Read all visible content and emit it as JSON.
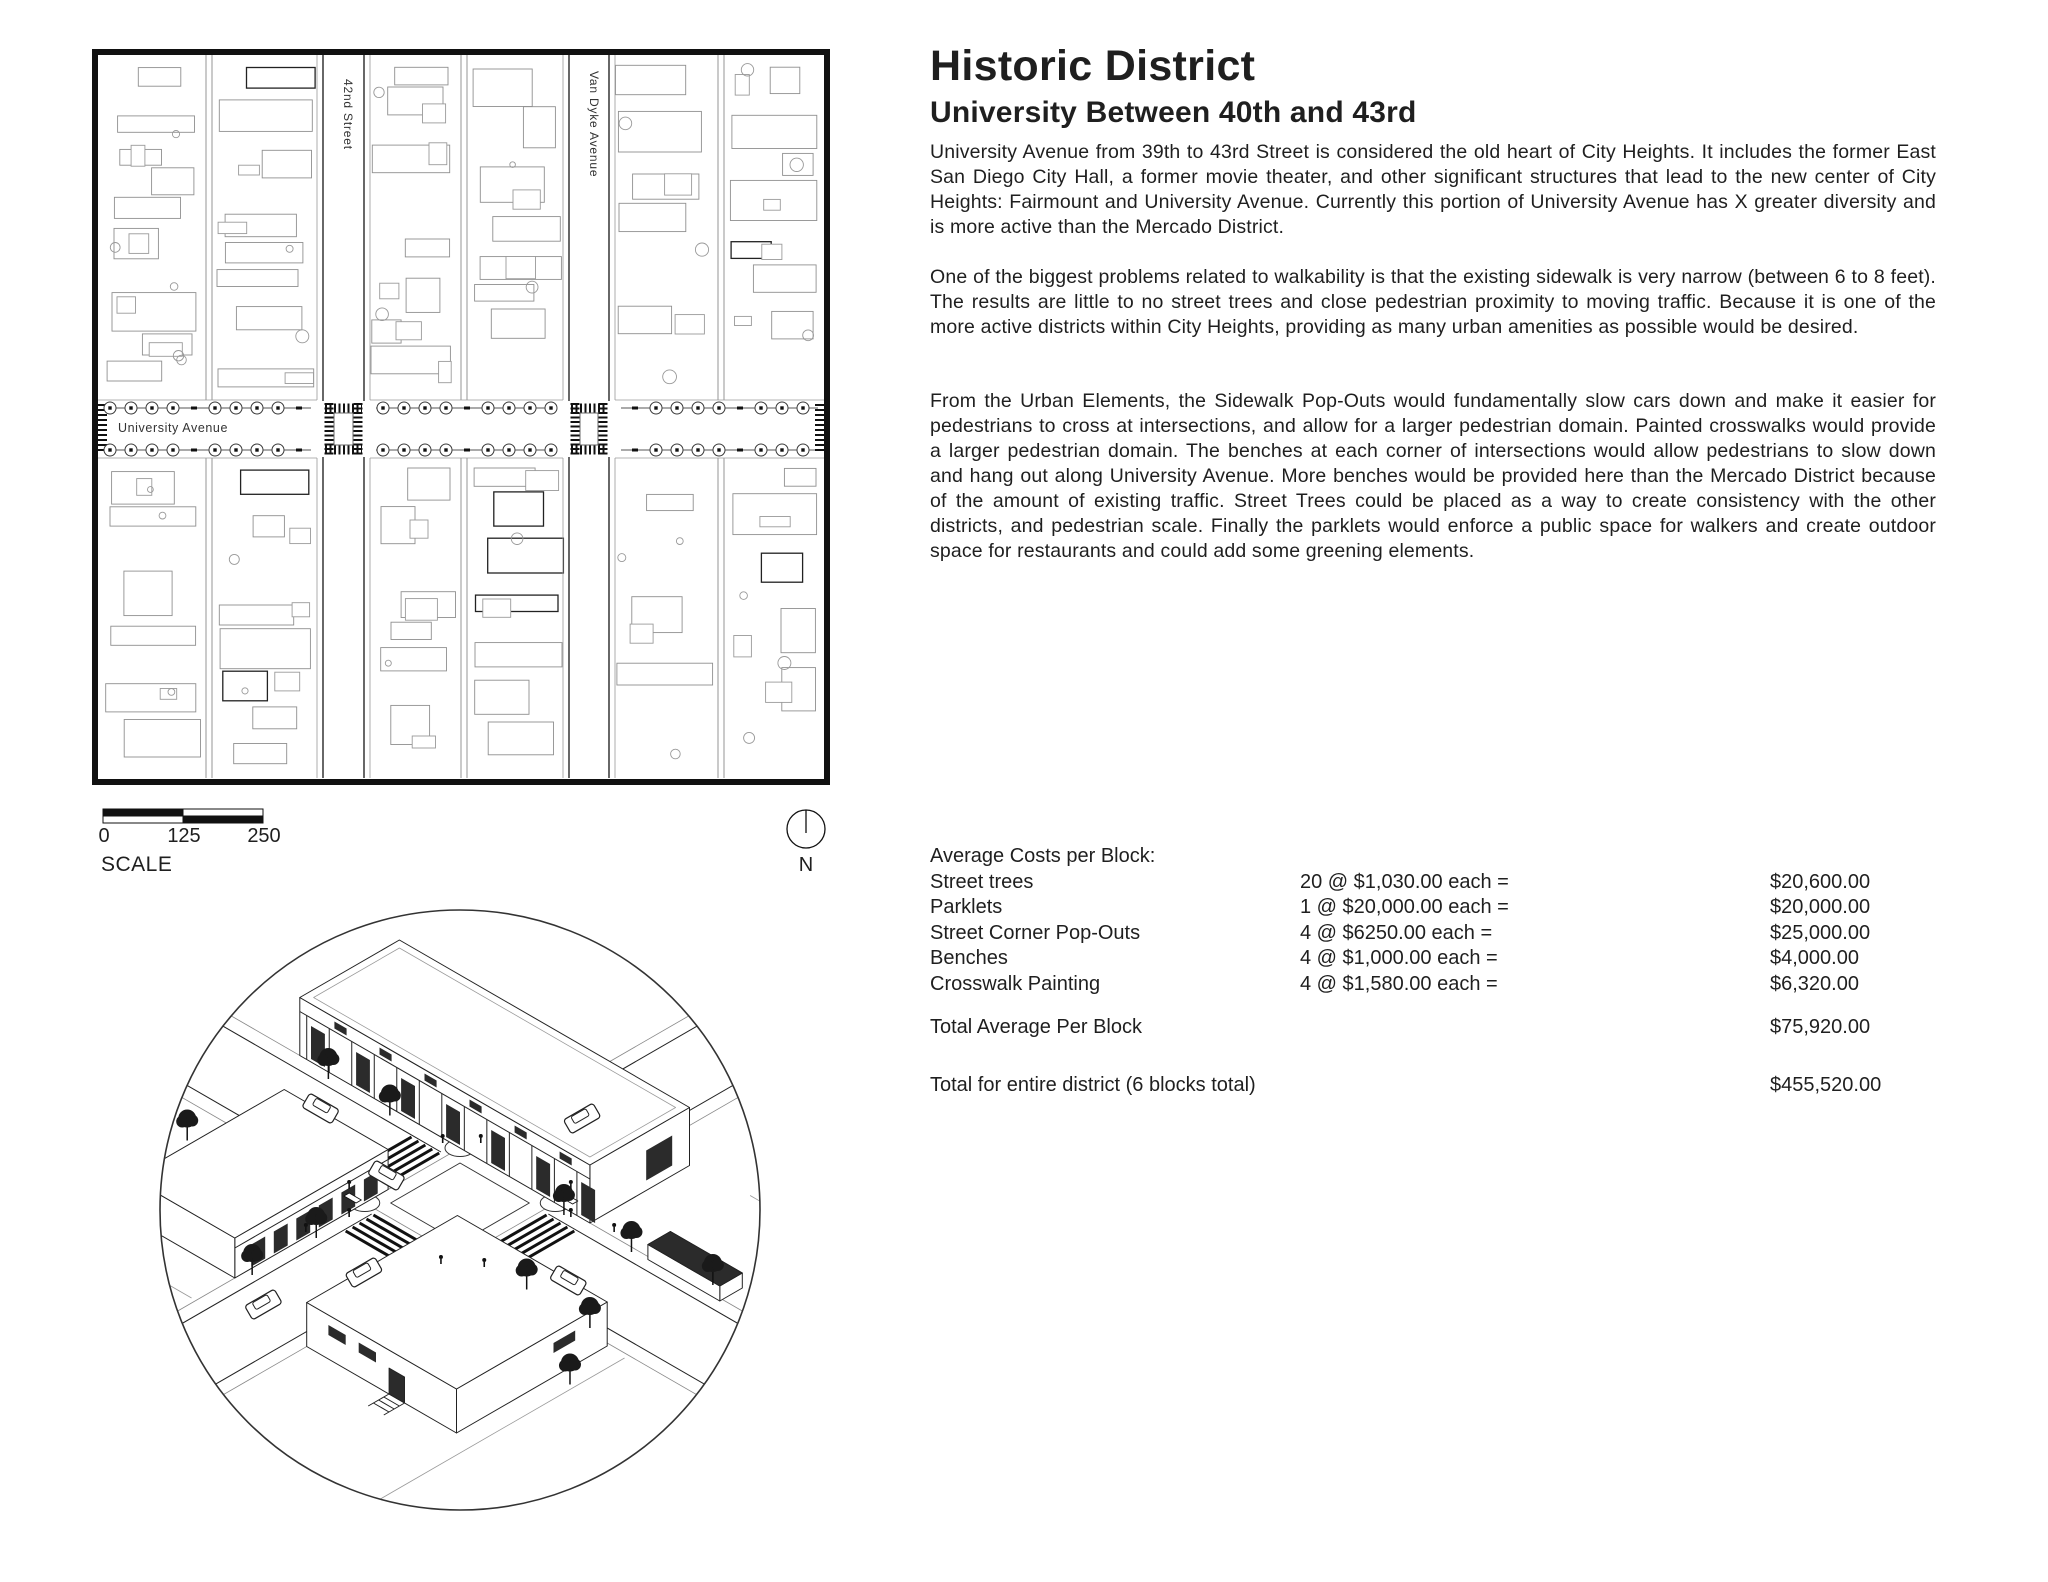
{
  "header": {
    "title": "Historic District",
    "subtitle": "University Between 40th and 43rd"
  },
  "paragraphs": {
    "p1": "University Avenue from 39th to 43rd Street is considered the old heart of City Heights. It includes the former East San Diego City Hall, a former movie theater, and other significant structures that lead to the new center of City Heights: Fairmount and University Avenue. Currently this portion of University Avenue has X greater diversity and is more active than the Mercado District.",
    "p2": "One of the biggest problems related to walkability is that the existing sidewalk is very narrow (between 6 to 8 feet). The results are little to no street trees and close pedestrian proximity to moving traffic. Because it is one of the more active districts within City Heights, providing as many urban amenities as possible would be desired.",
    "p3": "From the Urban Elements, the Sidewalk Pop-Outs would fundamentally slow cars down and make it easier for pedestrians to cross at intersections, and allow for a larger pedestrian domain. Painted crosswalks would provide a larger pedestrian domain. The benches at each corner of intersections would allow pedestrians to slow down and hang out along University Avenue. More benches would be provided here than the Mercado District because of the amount of existing traffic. Street Trees could be placed as a way to create consistency with the other districts, and pedestrian scale. Finally the parklets would enforce a public space for walkers and create outdoor space for restaurants and could add some greening elements."
  },
  "map": {
    "streets": {
      "horizontal": "University Avenue",
      "vertical_1": "42nd Street",
      "vertical_2": "Van Dyke Avenue"
    }
  },
  "scale_bar": {
    "tick_0": "0",
    "tick_125": "125",
    "tick_250": "250",
    "caption": "SCALE"
  },
  "north_arrow": {
    "label": "N"
  },
  "costs": {
    "heading": "Average Costs per Block:",
    "rows": [
      {
        "item": "Street trees",
        "qty": "20 @ $1,030.00 each =",
        "amount": "$20,600.00"
      },
      {
        "item": "Parklets",
        "qty": "1 @ $20,000.00 each =",
        "amount": "$20,000.00"
      },
      {
        "item": "Street Corner Pop-Outs",
        "qty": "4 @ $6250.00 each =",
        "amount": "$25,000.00"
      },
      {
        "item": "Benches",
        "qty": "4 @ $1,000.00 each =",
        "amount": "$4,000.00"
      },
      {
        "item": "Crosswalk Painting",
        "qty": "4 @ $1,580.00 each =",
        "amount": "$6,320.00"
      }
    ],
    "total_block": {
      "label": "Total Average Per Block",
      "amount": "$75,920.00"
    },
    "total_district": {
      "label": "Total for entire district (6 blocks total)",
      "amount": "$455,520.00"
    }
  },
  "colors": {
    "ink": "#1f1f1f",
    "map_line": "#111111",
    "building_gray": "#8f8f8f"
  }
}
